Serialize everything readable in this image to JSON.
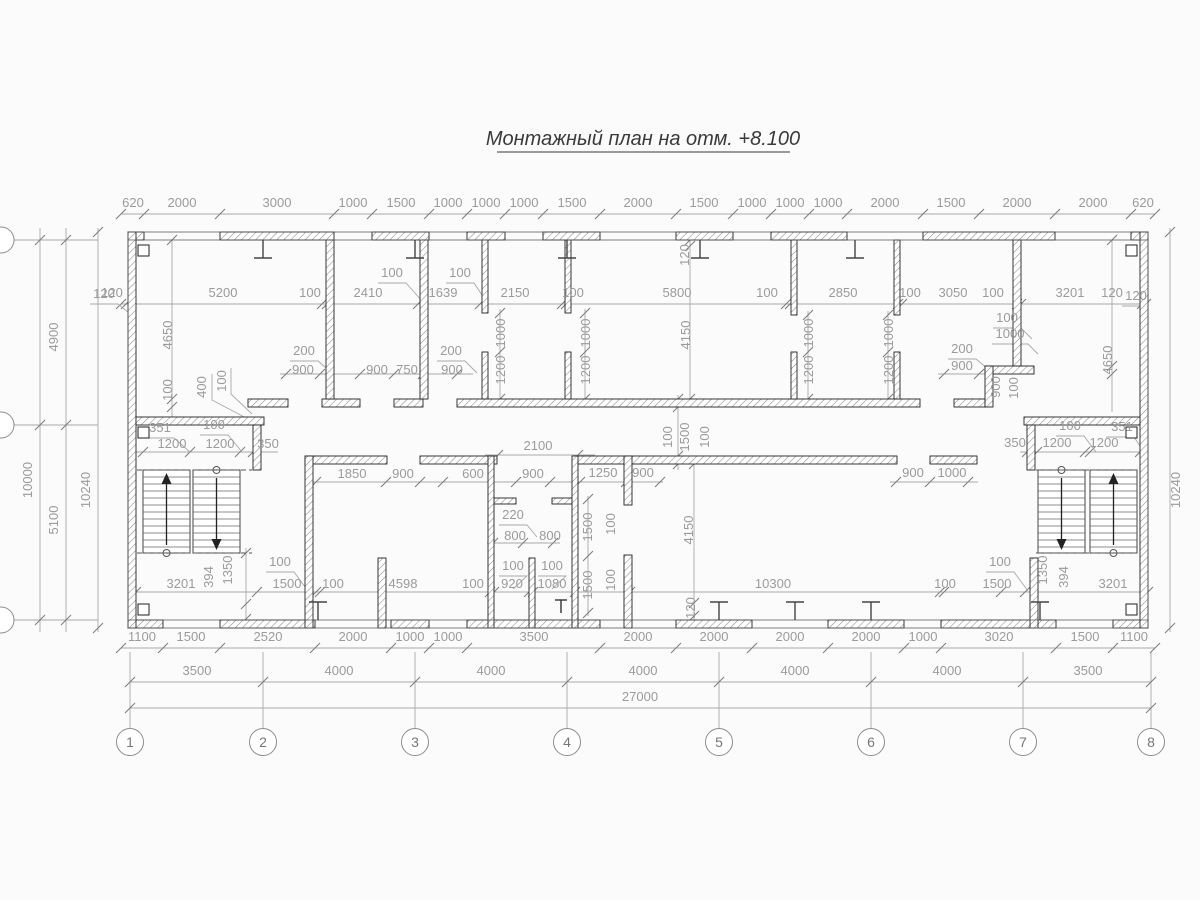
{
  "title": "Монтажный план на отм. +8.100",
  "colors": {
    "wall": "#222222",
    "dim_line": "#a9a9a9",
    "dim_text": "#9b9b9b",
    "title_text": "#3a3a3a"
  },
  "grid_axes_bottom": [
    {
      "label": "1",
      "x": 130
    },
    {
      "label": "2",
      "x": 263
    },
    {
      "label": "3",
      "x": 415
    },
    {
      "label": "4",
      "x": 567
    },
    {
      "label": "5",
      "x": 719
    },
    {
      "label": "6",
      "x": 871
    },
    {
      "label": "7",
      "x": 1023
    },
    {
      "label": "8",
      "x": 1151
    }
  ],
  "grid_axes_left_count": 3,
  "dim_labels": [
    [
      "620",
      133,
      207,
      0
    ],
    [
      "2000",
      182,
      207,
      0
    ],
    [
      "3000",
      277,
      207,
      0
    ],
    [
      "1000",
      353,
      207,
      0
    ],
    [
      "1500",
      401,
      207,
      0
    ],
    [
      "1000",
      448,
      207,
      0
    ],
    [
      "1000",
      486,
      207,
      0
    ],
    [
      "1000",
      524,
      207,
      0
    ],
    [
      "1500",
      572,
      207,
      0
    ],
    [
      "2000",
      638,
      207,
      0
    ],
    [
      "1500",
      704,
      207,
      0
    ],
    [
      "1000",
      752,
      207,
      0
    ],
    [
      "1000",
      790,
      207,
      0
    ],
    [
      "1000",
      828,
      207,
      0
    ],
    [
      "2000",
      885,
      207,
      0
    ],
    [
      "1500",
      951,
      207,
      0
    ],
    [
      "2000",
      1017,
      207,
      0
    ],
    [
      "2000",
      1093,
      207,
      0
    ],
    [
      "620",
      1143,
      207,
      0
    ],
    [
      "120",
      112,
      297,
      0
    ],
    [
      "5200",
      223,
      297,
      0
    ],
    [
      "100",
      310,
      297,
      0
    ],
    [
      "2410",
      368,
      297,
      0
    ],
    [
      "1639",
      443,
      297,
      0
    ],
    [
      "2150",
      515,
      297,
      0
    ],
    [
      "100",
      573,
      297,
      0
    ],
    [
      "5800",
      677,
      297,
      0
    ],
    [
      "100",
      767,
      297,
      0
    ],
    [
      "2850",
      843,
      297,
      0
    ],
    [
      "100",
      910,
      297,
      0
    ],
    [
      "3050",
      953,
      297,
      0
    ],
    [
      "100",
      993,
      297,
      0
    ],
    [
      "3201",
      1070,
      297,
      0
    ],
    [
      "120",
      1112,
      297,
      0
    ],
    [
      "100",
      392,
      277,
      0
    ],
    [
      "100",
      460,
      277,
      0
    ],
    [
      "4900",
      58,
      337,
      1
    ],
    [
      "10000",
      32,
      480,
      1
    ],
    [
      "5100",
      58,
      520,
      1
    ],
    [
      "10240",
      90,
      490,
      1
    ],
    [
      "120",
      104,
      298,
      0
    ],
    [
      "10240",
      1180,
      490,
      1
    ],
    [
      "120",
      1136,
      300,
      0
    ],
    [
      "4650",
      1112,
      360,
      1
    ],
    [
      "4650",
      172,
      335,
      1
    ],
    [
      "100",
      172,
      390,
      1
    ],
    [
      "400",
      206,
      387,
      1
    ],
    [
      "100",
      226,
      381,
      1
    ],
    [
      "900",
      303,
      374,
      0
    ],
    [
      "900",
      377,
      374,
      0
    ],
    [
      "750",
      407,
      374,
      0
    ],
    [
      "900",
      452,
      374,
      0
    ],
    [
      "200",
      304,
      355,
      0
    ],
    [
      "200",
      451,
      355,
      0
    ],
    [
      "1000",
      505,
      333,
      1
    ],
    [
      "1200",
      505,
      370,
      1
    ],
    [
      "1000",
      590,
      333,
      1
    ],
    [
      "1200",
      590,
      370,
      1
    ],
    [
      "1000",
      813,
      333,
      1
    ],
    [
      "1200",
      813,
      370,
      1
    ],
    [
      "1000",
      893,
      333,
      1
    ],
    [
      "1200",
      893,
      370,
      1
    ],
    [
      "4150",
      690,
      335,
      1
    ],
    [
      "120",
      689,
      255,
      1
    ],
    [
      "4150",
      693,
      530,
      1
    ],
    [
      "120",
      695,
      608,
      1
    ],
    [
      "100",
      672,
      437,
      1
    ],
    [
      "1500",
      689,
      437,
      1
    ],
    [
      "100",
      709,
      437,
      1
    ],
    [
      "2100",
      538,
      450,
      0
    ],
    [
      "100",
      1007,
      322,
      0
    ],
    [
      "1000",
      1010,
      338,
      0
    ],
    [
      "200",
      962,
      353,
      0
    ],
    [
      "900",
      962,
      370,
      0
    ],
    [
      "900",
      1000,
      387,
      1
    ],
    [
      "100",
      1018,
      388,
      1
    ],
    [
      "350",
      1015,
      447,
      0
    ],
    [
      "1200",
      1057,
      447,
      0
    ],
    [
      "1200",
      1104,
      447,
      0
    ],
    [
      "100",
      1070,
      430,
      0
    ],
    [
      "351",
      1122,
      431,
      0
    ],
    [
      "351",
      160,
      432,
      0
    ],
    [
      "100",
      214,
      429,
      0
    ],
    [
      "1200",
      172,
      448,
      0
    ],
    [
      "1200",
      220,
      448,
      0
    ],
    [
      "350",
      268,
      448,
      0
    ],
    [
      "1850",
      352,
      478,
      0
    ],
    [
      "900",
      403,
      478,
      0
    ],
    [
      "600",
      473,
      478,
      0
    ],
    [
      "900",
      533,
      478,
      0
    ],
    [
      "1250",
      603,
      477,
      0
    ],
    [
      "900",
      643,
      477,
      0
    ],
    [
      "900",
      913,
      477,
      0
    ],
    [
      "1000",
      952,
      477,
      0
    ],
    [
      "220",
      513,
      519,
      0
    ],
    [
      "800",
      515,
      540,
      0
    ],
    [
      "800",
      550,
      540,
      0
    ],
    [
      "100",
      513,
      570,
      0
    ],
    [
      "100",
      552,
      570,
      0
    ],
    [
      "1500",
      592,
      527,
      1
    ],
    [
      "100",
      615,
      524,
      1
    ],
    [
      "1500",
      592,
      585,
      1
    ],
    [
      "100",
      615,
      580,
      1
    ],
    [
      "3201",
      181,
      588,
      0
    ],
    [
      "1500",
      287,
      588,
      0
    ],
    [
      "100",
      333,
      588,
      0
    ],
    [
      "4598",
      403,
      588,
      0
    ],
    [
      "100",
      473,
      588,
      0
    ],
    [
      "920",
      512,
      588,
      0
    ],
    [
      "1080",
      552,
      588,
      0
    ],
    [
      "10300",
      773,
      588,
      0
    ],
    [
      "100",
      945,
      588,
      0
    ],
    [
      "1500",
      997,
      588,
      0
    ],
    [
      "3201",
      1113,
      588,
      0
    ],
    [
      "394",
      213,
      577,
      1
    ],
    [
      "1350",
      232,
      570,
      1
    ],
    [
      "1350",
      1047,
      570,
      1
    ],
    [
      "394",
      1068,
      577,
      1
    ],
    [
      "100",
      280,
      566,
      0
    ],
    [
      "100",
      1000,
      566,
      0
    ],
    [
      "1100",
      142,
      641,
      0
    ],
    [
      "1500",
      191,
      641,
      0
    ],
    [
      "2520",
      268,
      641,
      0
    ],
    [
      "2000",
      353,
      641,
      0
    ],
    [
      "1000",
      410,
      641,
      0
    ],
    [
      "1000",
      448,
      641,
      0
    ],
    [
      "3500",
      534,
      641,
      0
    ],
    [
      "2000",
      638,
      641,
      0
    ],
    [
      "2000",
      714,
      641,
      0
    ],
    [
      "2000",
      790,
      641,
      0
    ],
    [
      "2000",
      866,
      641,
      0
    ],
    [
      "1000",
      923,
      641,
      0
    ],
    [
      "3020",
      999,
      641,
      0
    ],
    [
      "1500",
      1085,
      641,
      0
    ],
    [
      "1100",
      1134,
      641,
      0
    ],
    [
      "3500",
      197,
      675,
      0
    ],
    [
      "4000",
      339,
      675,
      0
    ],
    [
      "4000",
      491,
      675,
      0
    ],
    [
      "4000",
      643,
      675,
      0
    ],
    [
      "4000",
      795,
      675,
      0
    ],
    [
      "4000",
      947,
      675,
      0
    ],
    [
      "3500",
      1088,
      675,
      0
    ],
    [
      "27000",
      640,
      701,
      0
    ]
  ]
}
